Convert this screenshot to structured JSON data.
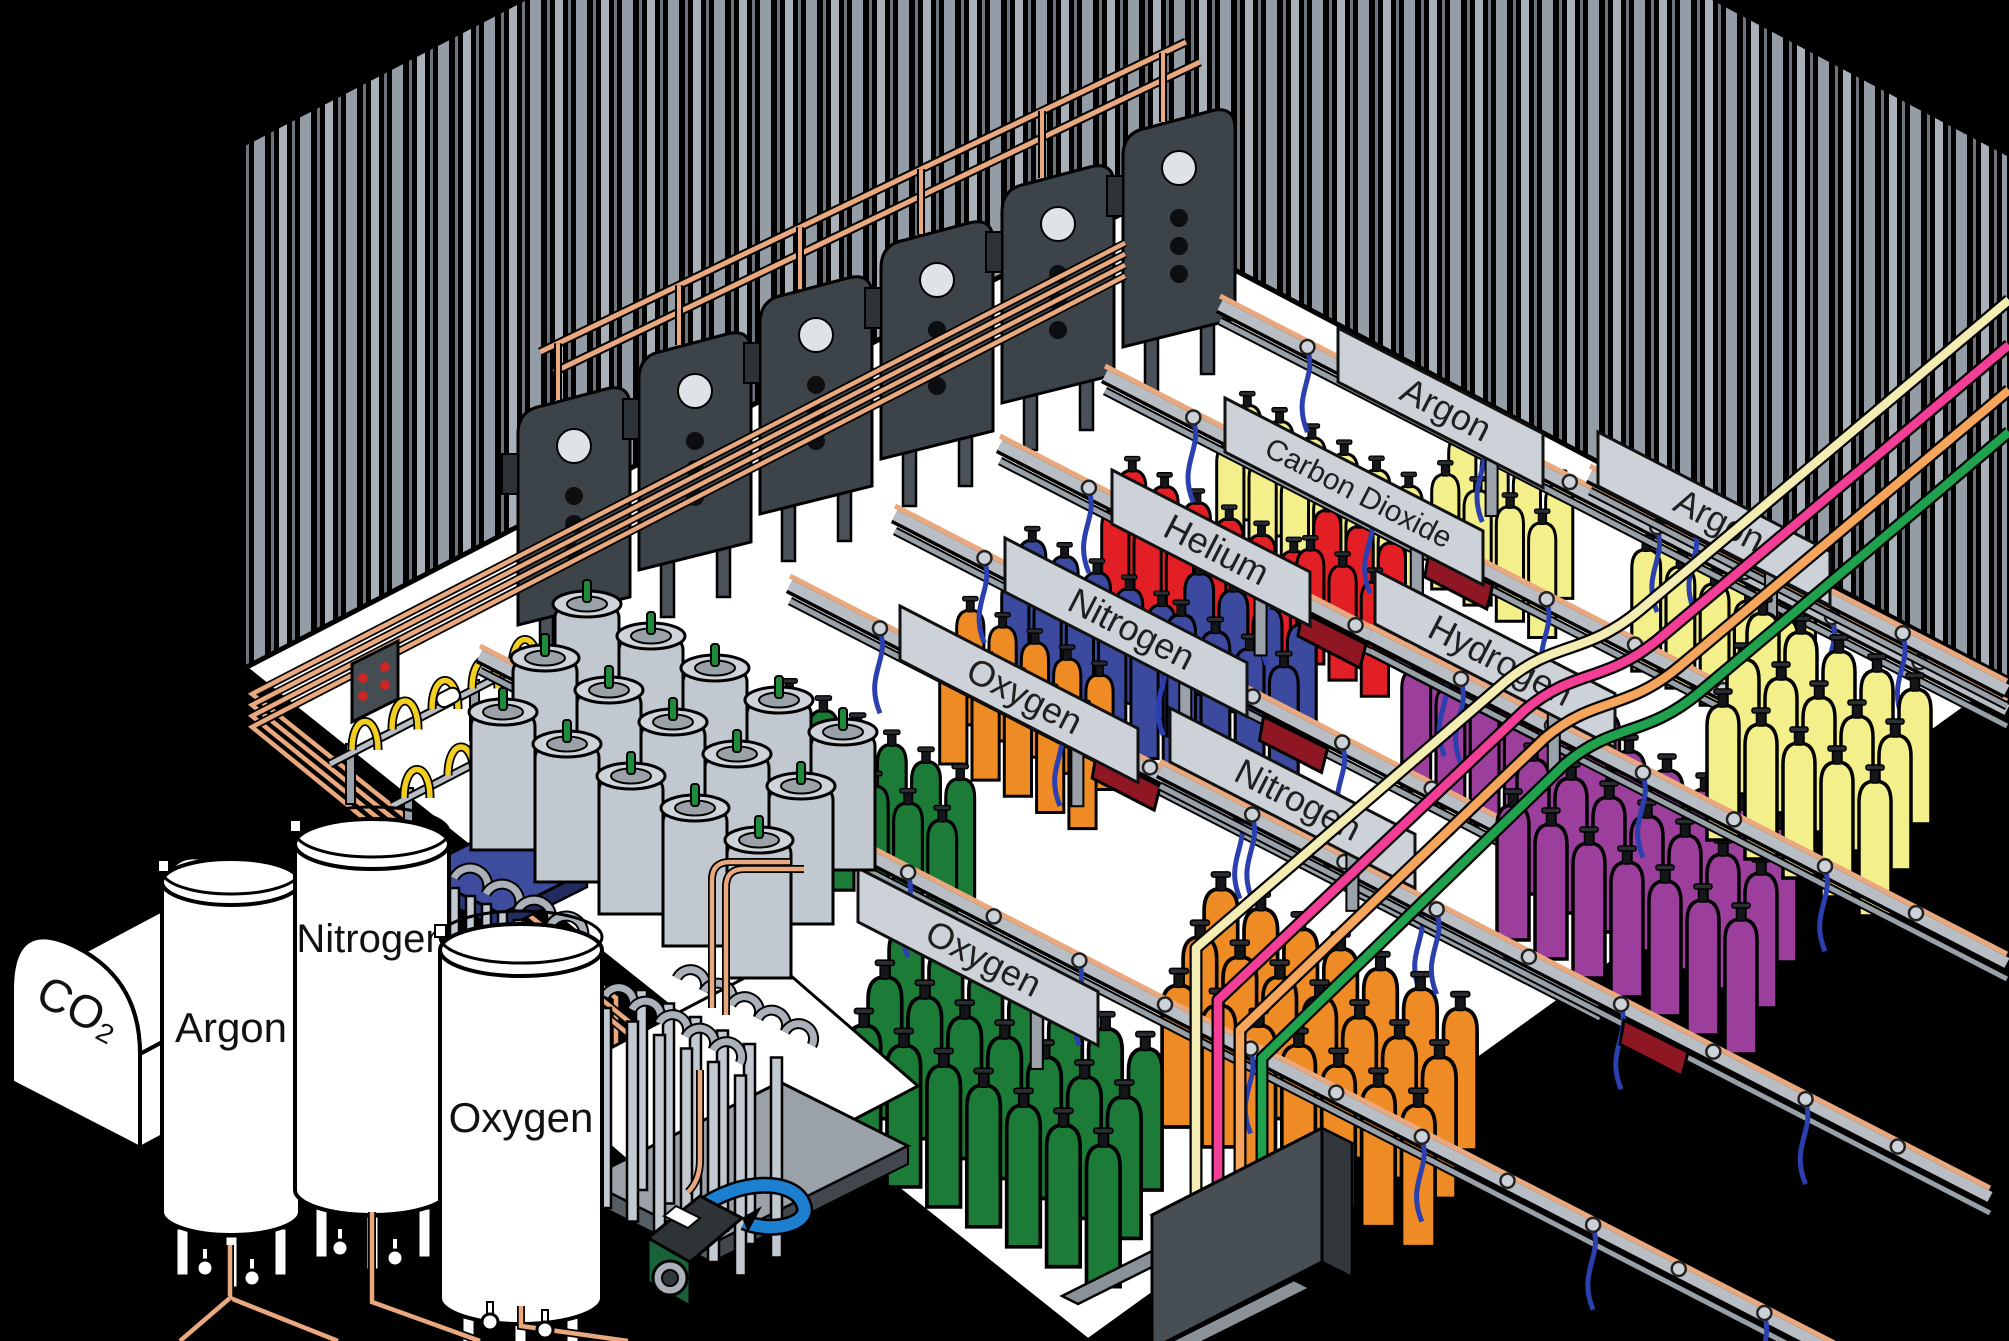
{
  "title": "Industrial gas cylinder filling plant (isometric cutaway diagram)",
  "labels": {
    "station_argon_top": "Argon",
    "station_carbon_dioxide": "Carbon Dioxide",
    "station_helium": "Helium",
    "station_nitrogen_upper": "Nitrogen",
    "station_oxygen_upper": "Oxygen",
    "station_hydrogen": "Hydrogen",
    "station_nitrogen_middle": "Nitrogen",
    "station_argon_right": "Argon",
    "station_oxygen_lower": "Oxygen",
    "tank_co2": "CO₂",
    "tank_argon": "Argon",
    "tank_nitrogen": "Nitrogen",
    "tank_oxygen": "Oxygen"
  },
  "colors": {
    "cyl_green": "#1d7b38",
    "cyl_orange": "#ef8b25",
    "cyl_blue": "#3b4a9f",
    "cyl_red": "#e31f26",
    "cyl_yellow": "#f3f08c",
    "cyl_purple": "#9c3f9c",
    "dewar_gray": "#c2c8cf",
    "copper": "#e9a87d",
    "hose_blue": "#2b3fae",
    "cart_red": "#8f1623",
    "line_cream": "#f3edb4",
    "line_pink": "#f23e97",
    "line_orange": "#f5a55c",
    "line_green": "#1fa14d",
    "scale_blue": "#3e4c9e",
    "sign_gray": "#cdd2d8",
    "rail_gray": "#b8bec4",
    "wall_stripe": "#a9b0b8",
    "floor_white": "#ffffff",
    "pump_green": "#176238",
    "pump_blue": "#1d7fd0"
  },
  "scene": {
    "signs": [
      {
        "key": "station_argon_top",
        "layer": "layer-upper-rails",
        "x": 1338,
        "y": 328,
        "w": 205
      },
      {
        "key": "station_carbon_dioxide",
        "layer": "layer-upper-rails",
        "x": 1225,
        "y": 398,
        "w": 258
      },
      {
        "key": "station_helium",
        "layer": "layer-upper-rails",
        "x": 1112,
        "y": 470,
        "w": 198
      },
      {
        "key": "station_nitrogen_upper",
        "layer": "layer-upper-rails",
        "x": 1005,
        "y": 538,
        "w": 242
      },
      {
        "key": "station_oxygen_upper",
        "layer": "layer-upper-rails",
        "x": 900,
        "y": 606,
        "w": 238
      },
      {
        "key": "station_argon_right",
        "layer": "layer-upper-rails",
        "x": 1598,
        "y": 432,
        "w": 232
      },
      {
        "key": "station_hydrogen",
        "layer": "layer-front-rails",
        "x": 1375,
        "y": 570,
        "w": 240
      },
      {
        "key": "station_nitrogen_middle",
        "layer": "layer-front-rails",
        "x": 1170,
        "y": 708,
        "w": 245
      },
      {
        "key": "station_oxygen_lower",
        "layer": "layer-front-rails",
        "x": 858,
        "y": 868,
        "w": 240
      }
    ],
    "rails": [
      {
        "layer": "layer-upper-rails",
        "x1": 1220,
        "y1": 305,
        "x2": 2007,
        "y2": 710
      },
      {
        "layer": "layer-upper-rails",
        "x1": 1105,
        "y1": 375,
        "x2": 1900,
        "y2": 784,
        "cart": 0.45
      },
      {
        "layer": "layer-upper-rails",
        "x1": 1000,
        "y1": 445,
        "x2": 1800,
        "y2": 857,
        "cart": 0.42
      },
      {
        "layer": "layer-upper-rails",
        "x1": 895,
        "y1": 515,
        "x2": 1700,
        "y2": 930,
        "cart": 0.5
      },
      {
        "layer": "layer-upper-rails",
        "x1": 790,
        "y1": 585,
        "x2": 1600,
        "y2": 1002,
        "cart": 0.42
      },
      {
        "layer": "layer-upper-rails",
        "x1": 1590,
        "y1": 475,
        "x2": 2007,
        "y2": 690
      },
      {
        "layer": "layer-front-rails",
        "x1": 1370,
        "y1": 635,
        "x2": 2007,
        "y2": 963
      },
      {
        "layer": "layer-front-rails",
        "x1": 1160,
        "y1": 770,
        "x2": 1990,
        "y2": 1197,
        "cart": 0.6
      },
      {
        "layer": "layer-front-rails",
        "x1": 480,
        "y1": 655,
        "x2": 1850,
        "y2": 1360
      }
    ],
    "cylinder_groups": [
      {
        "layer": "layer-upper-cyl",
        "color": "cyl_yellow",
        "x": 1215,
        "y": 440,
        "cols": 6,
        "rows": 2,
        "s": 0.85
      },
      {
        "layer": "layer-upper-cyl",
        "color": "cyl_yellow",
        "x": 1430,
        "y": 470,
        "cols": 4,
        "rows": 2,
        "s": 0.85
      },
      {
        "layer": "layer-upper-cyl",
        "color": "cyl_red",
        "x": 1100,
        "y": 505,
        "cols": 6,
        "rows": 2,
        "s": 0.85
      },
      {
        "layer": "layer-upper-cyl",
        "color": "cyl_red",
        "x": 1295,
        "y": 545,
        "cols": 3,
        "rows": 2,
        "s": 0.85
      },
      {
        "layer": "layer-upper-cyl",
        "color": "cyl_blue",
        "x": 1000,
        "y": 575,
        "cols": 6,
        "rows": 2,
        "s": 0.85
      },
      {
        "layer": "layer-upper-cyl",
        "color": "cyl_blue",
        "x": 1165,
        "y": 610,
        "cols": 4,
        "rows": 2,
        "s": 0.9
      },
      {
        "layer": "layer-upper-cyl",
        "color": "cyl_orange",
        "x": 938,
        "y": 645,
        "cols": 5,
        "rows": 2,
        "s": 0.85
      },
      {
        "layer": "layer-upper-cyl",
        "color": "cyl_green",
        "x": 755,
        "y": 730,
        "cols": 6,
        "rows": 2,
        "s": 0.9
      },
      {
        "layer": "layer-upper-cyl",
        "color": "cyl_yellow",
        "x": 1630,
        "y": 545,
        "cols": 5,
        "rows": 2,
        "s": 0.9
      },
      {
        "layer": "layer-upper-cyl",
        "color": "cyl_purple",
        "x": 1400,
        "y": 665,
        "cols": 6,
        "rows": 2,
        "s": 0.9
      },
      {
        "layer": "layer-front-cyl",
        "color": "cyl_purple",
        "x": 1495,
        "y": 800,
        "cols": 7,
        "rows": 3,
        "s": 1
      },
      {
        "layer": "layer-front-cyl",
        "color": "cyl_yellow",
        "x": 1705,
        "y": 700,
        "cols": 5,
        "rows": 3,
        "s": 1
      },
      {
        "layer": "layer-front-cyl",
        "color": "cyl_orange",
        "x": 1160,
        "y": 980,
        "cols": 7,
        "rows": 3,
        "s": 1.05
      },
      {
        "layer": "layer-front-cyl",
        "color": "cyl_green",
        "x": 845,
        "y": 1020,
        "cols": 7,
        "rows": 3,
        "s": 1.05
      },
      {
        "layer": "layer-fore",
        "sym": "dewar",
        "color": "dewar_gray",
        "x": 468,
        "y": 700,
        "cols": 5,
        "rows": 3,
        "s": 1,
        "cs": [
          64,
          32
        ],
        "rs": [
          42,
          -54
        ]
      }
    ],
    "panels": [
      {
        "x": 518,
        "y": 410
      },
      {
        "x": 639,
        "y": 355
      },
      {
        "x": 760,
        "y": 299
      },
      {
        "x": 881,
        "y": 244
      },
      {
        "x": 1002,
        "y": 188
      },
      {
        "x": 1123,
        "y": 132
      }
    ]
  }
}
